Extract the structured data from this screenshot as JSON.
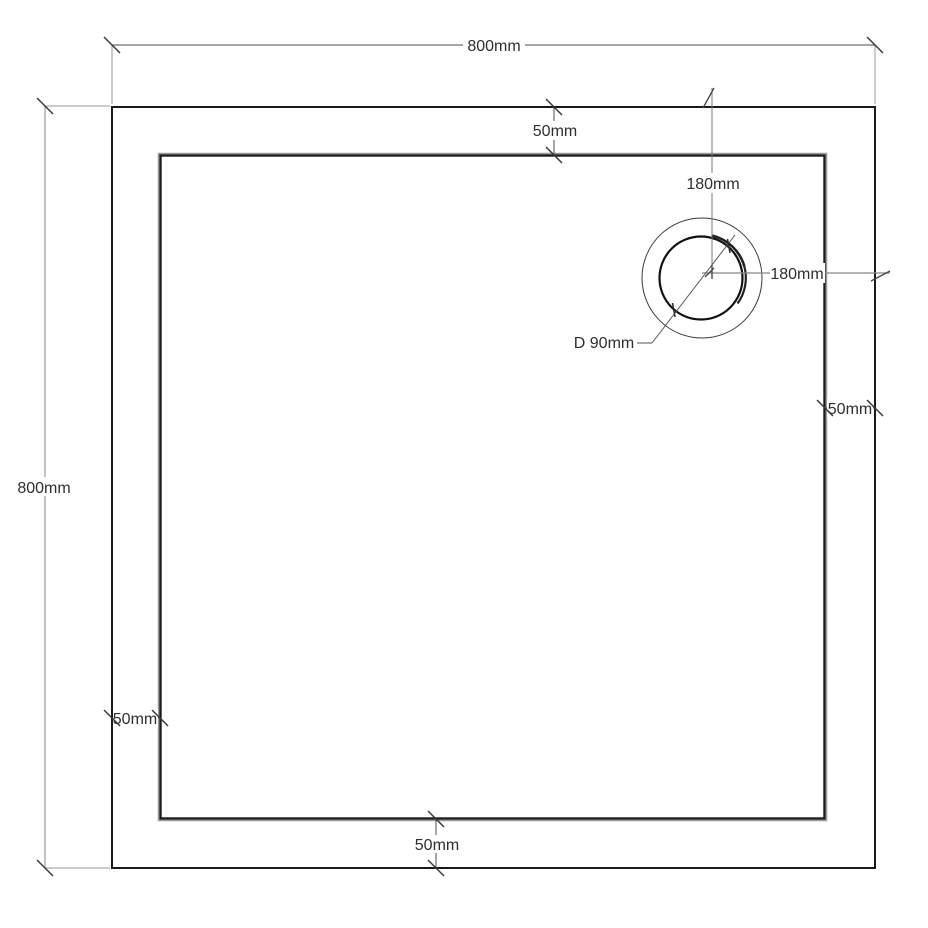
{
  "drawing": {
    "type": "technical-dimension-drawing",
    "background_color": "#ffffff",
    "outline_color": "#1a1a1a",
    "dimension_line_color": "#666666",
    "text_color": "#2e2e2e",
    "labels": {
      "overall_width": "800mm",
      "overall_height": "800mm",
      "rim_top": "50mm",
      "rim_right": "50mm",
      "rim_left": "50mm",
      "rim_bottom": "50mm",
      "drain_offset_from_top": "180mm",
      "drain_offset_from_right": "180mm",
      "drain_diameter": "D 90mm"
    }
  }
}
